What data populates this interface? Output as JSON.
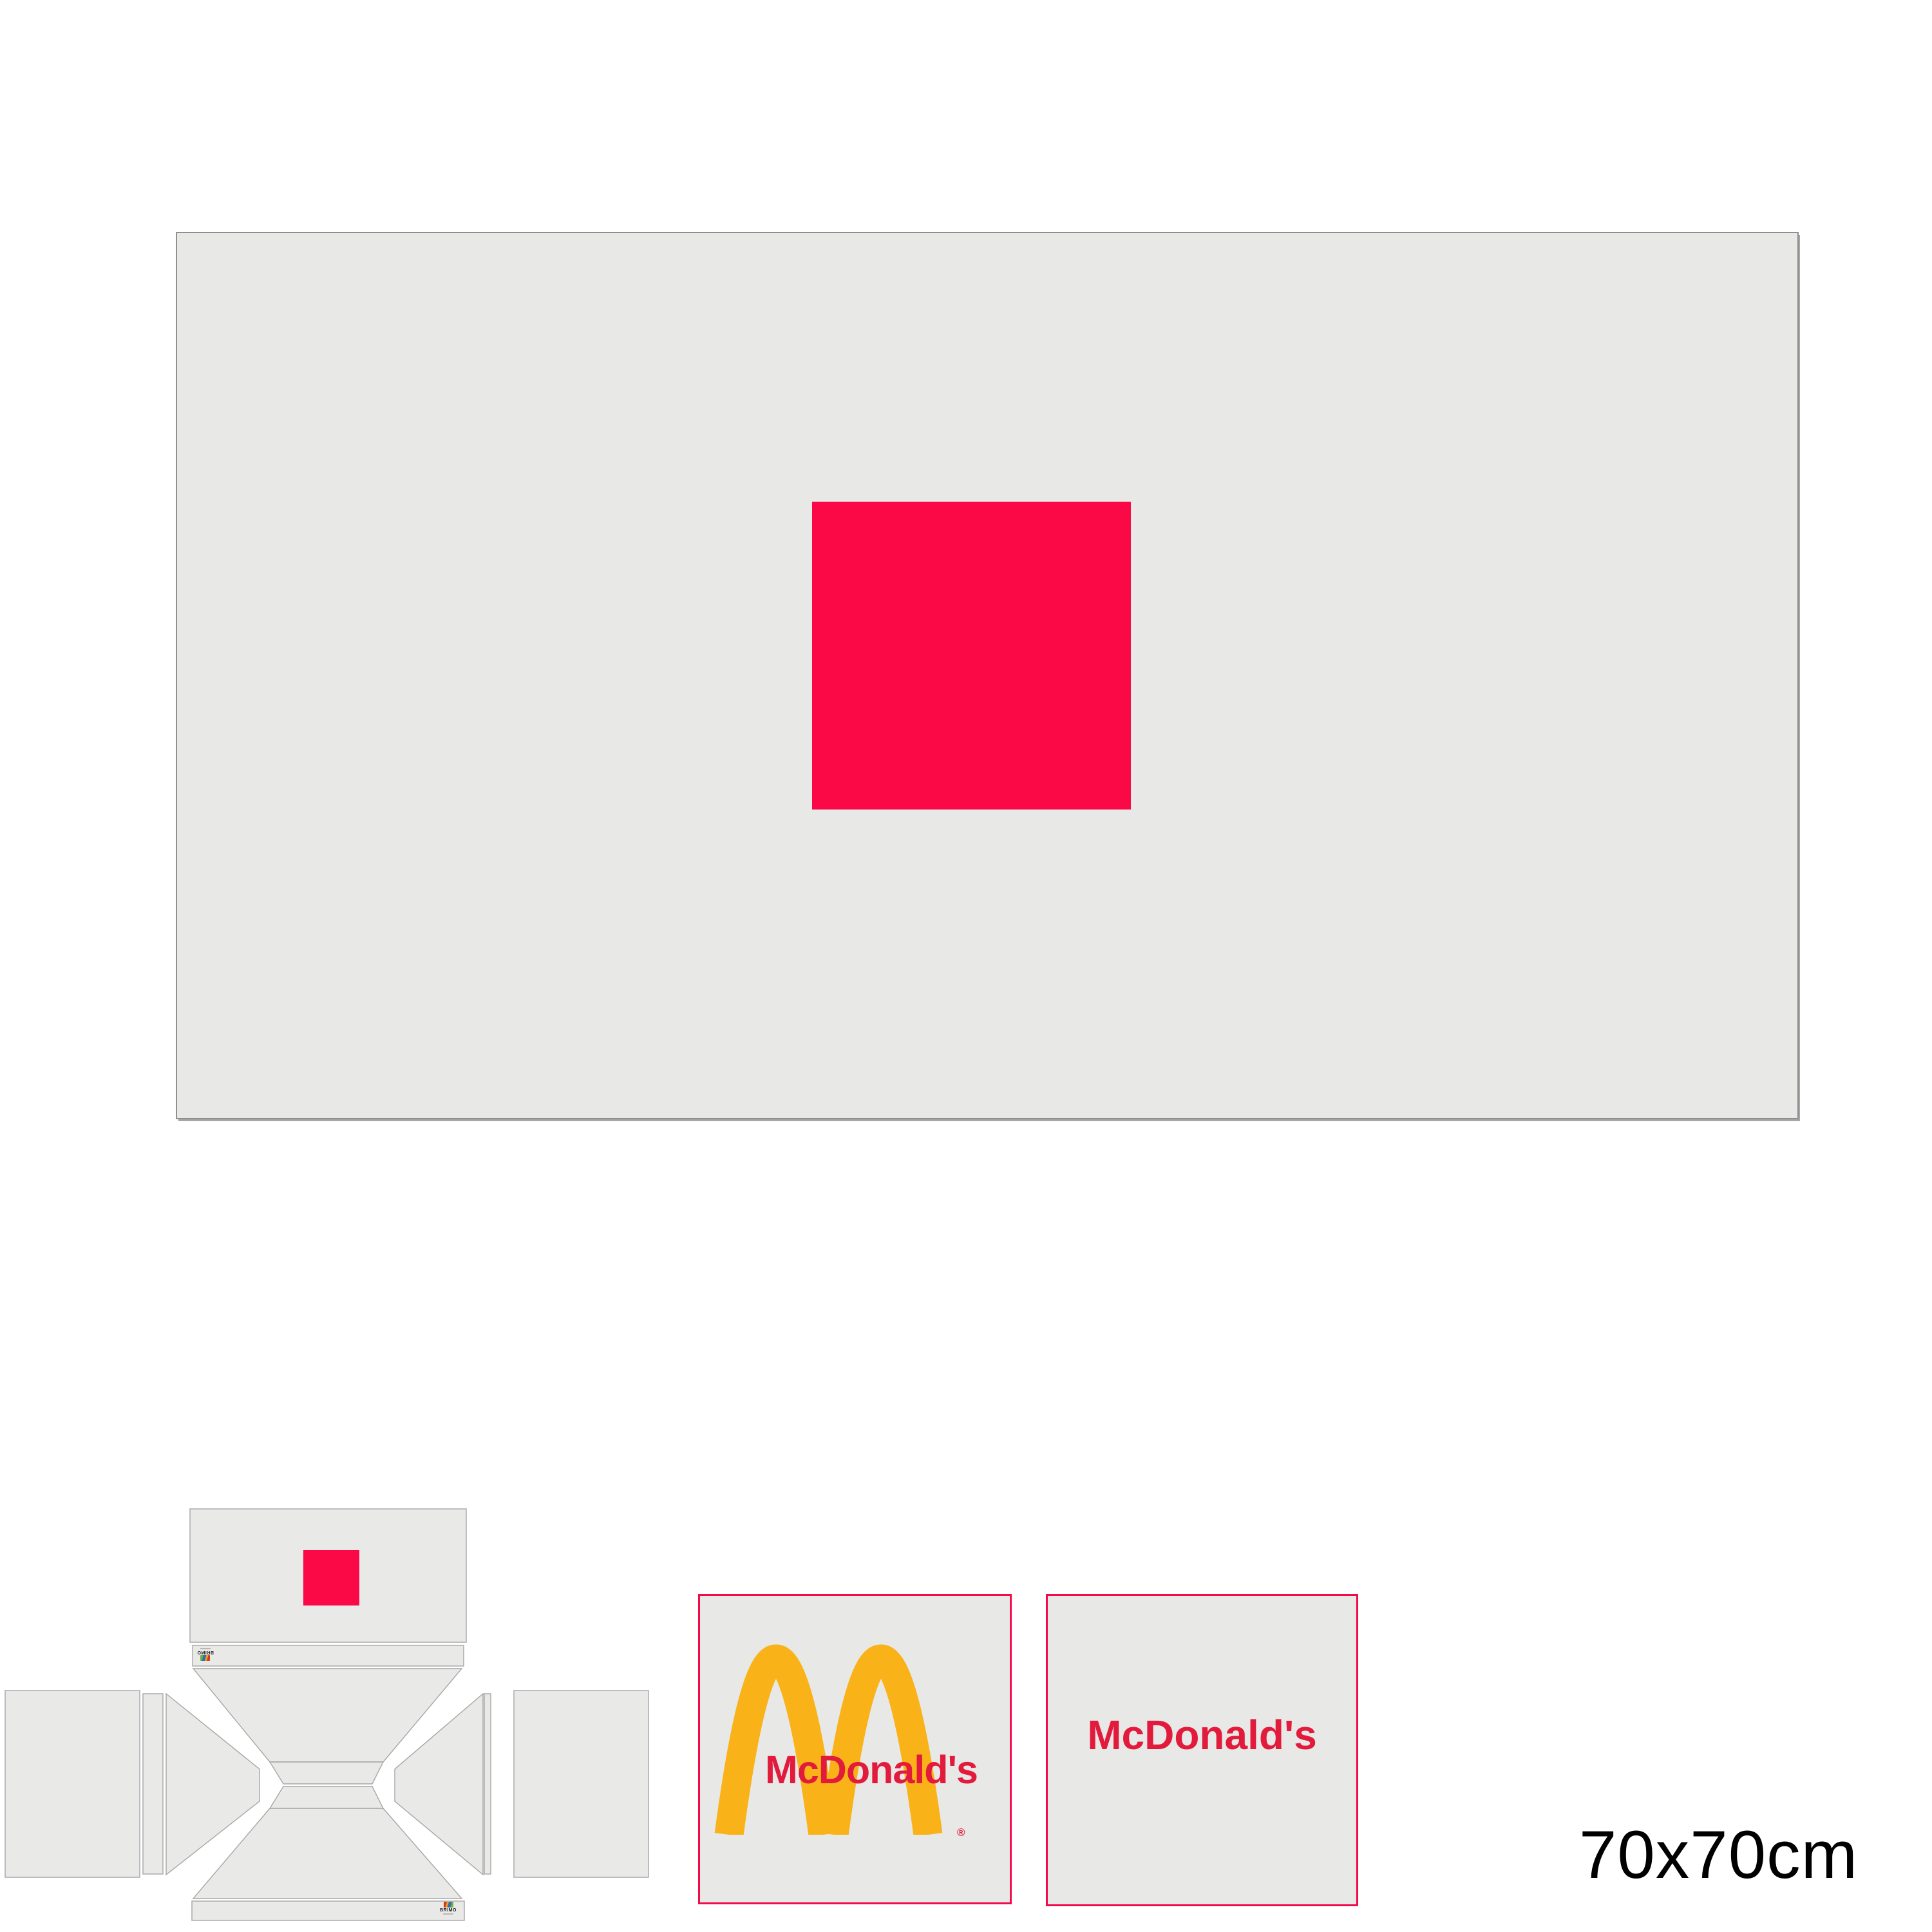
{
  "artboard": {
    "size_label": "70x70cm"
  },
  "colors": {
    "page_background": "#FFFFFF",
    "panel_fill": "#E8E8E7",
    "panel_outline": "#A6A6A6",
    "big_panel_border": "#8F8F8F",
    "accent_pink": "#FA0946",
    "swatch_border_pink": "#F20A4B",
    "mcdonalds_red": "#E21B3C",
    "arches_gold": "#F9B218",
    "label_color": "#000000"
  },
  "icons": {
    "brimo_mark": "multicolor-print-registration-mark",
    "arches": "mcdonalds-golden-arches"
  },
  "dieline": {
    "brand_label": "BRIMO"
  },
  "swatches": {
    "arches_swatch": {
      "wordmark": "McDonald's",
      "registered_mark": "®"
    },
    "wordmark_swatch": {
      "wordmark": "McDonald's"
    }
  }
}
